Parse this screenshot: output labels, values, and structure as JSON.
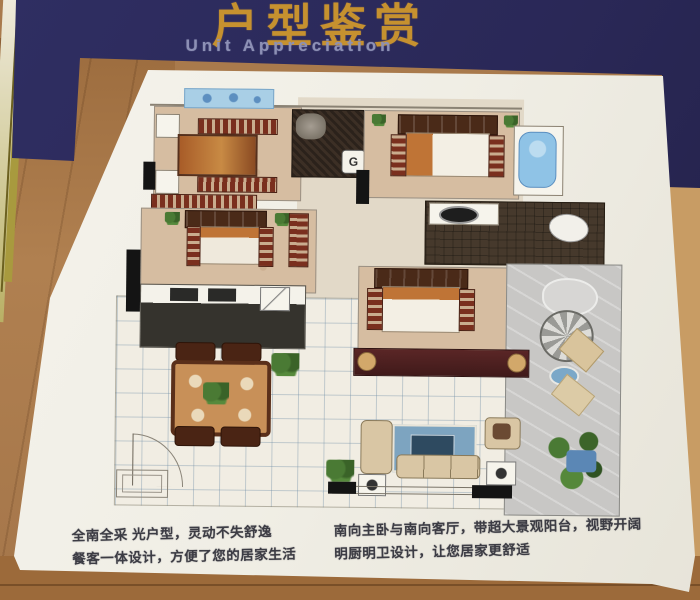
{
  "banner": {
    "title": "户型鉴赏",
    "subtitle": "Unit Appreciation"
  },
  "captions": {
    "left": [
      "全南全采 光户型，灵动不失舒逸",
      "餐客一体设计，方便了您的居家生活"
    ],
    "right": [
      "南向主卧与南向客厅，带超大景观阳台，视野开阔",
      "明厨明卫设计，让您居家更舒适"
    ]
  },
  "floor_plan": {
    "stove_label": "G"
  },
  "palette": {
    "navy": "#2a2857",
    "gold": "#c6912f",
    "en": "#8d90b5",
    "wall": "#a97a4c",
    "tan": "#d6bda1",
    "darkroom": "#3c2f25",
    "bath": "#46392c",
    "terrace": "#c8c7c5",
    "orange": "#bf7436",
    "beige": "#d9c6a4",
    "rug": "#7da4c0",
    "cap": "#3c3c44",
    "slat1": "#7a2f1e",
    "slat2": "#c9ac8e",
    "tileline": "rgba(110,140,165,0.38)"
  }
}
